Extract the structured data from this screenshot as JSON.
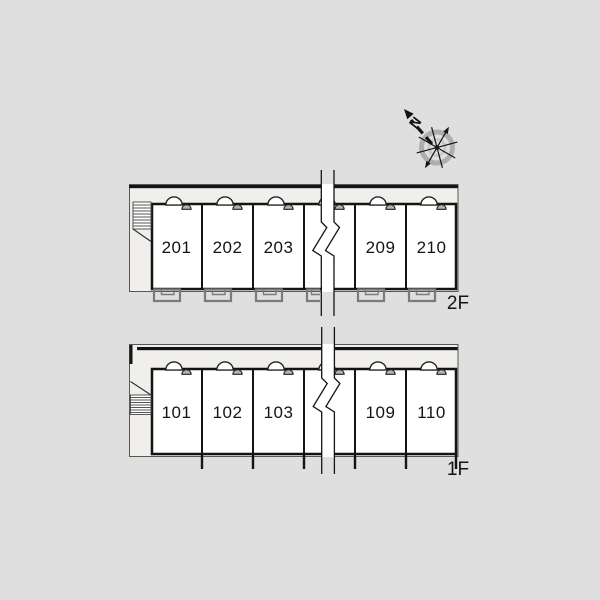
{
  "page": {
    "background_color": "#dfdfdf"
  },
  "compass": {
    "north_label": "N"
  },
  "floors": [
    {
      "label": "2F",
      "rooms": [
        "201",
        "202",
        "203",
        "209",
        "210"
      ]
    },
    {
      "label": "1F",
      "rooms": [
        "101",
        "102",
        "103",
        "109",
        "110"
      ]
    }
  ],
  "colors": {
    "wall": "#141414",
    "plan_outline": "#575757",
    "corridor_fill": "#f0efeb",
    "room_fill": "#ffffff",
    "balcony_outline": "#7b7b7b",
    "door_leaf_fill": "#b4b4b4",
    "compass_ring": "#a9a9a9"
  }
}
